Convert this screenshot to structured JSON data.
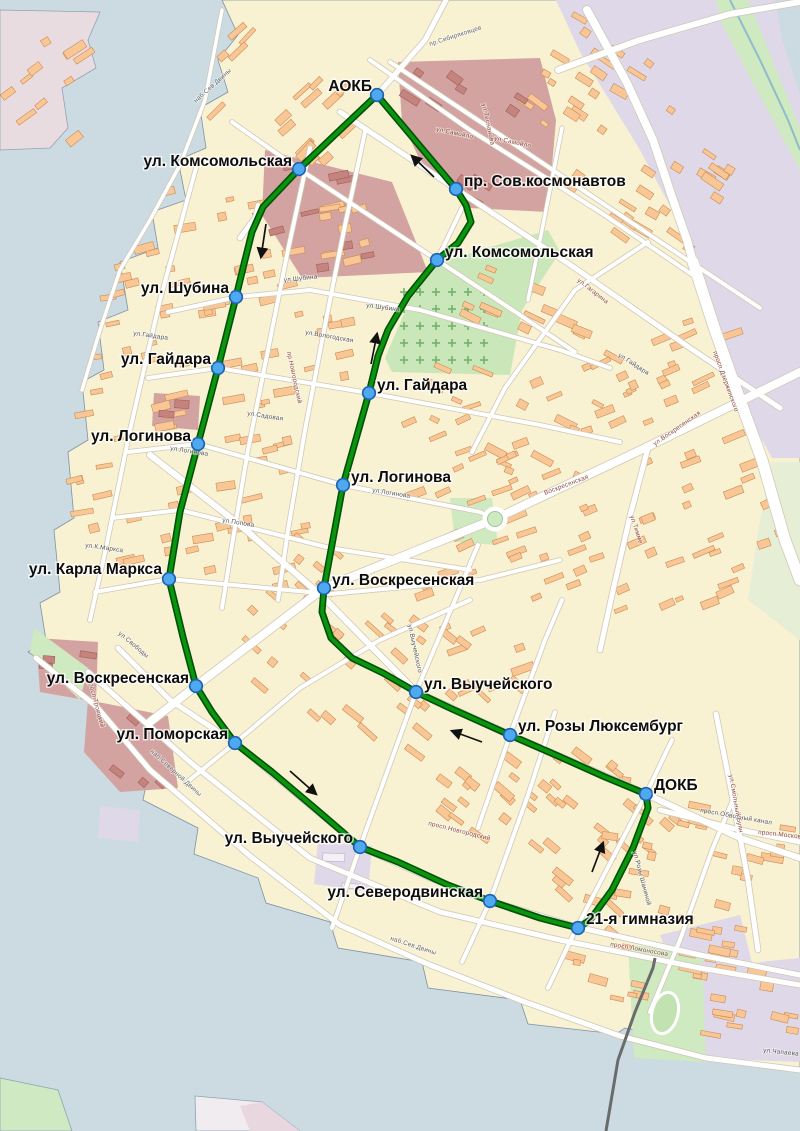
{
  "map": {
    "description": "City bus route map with stops",
    "colors": {
      "water": "#cbdbe1",
      "land": "#f8f1d2",
      "industrial_zone": "#ded8e9",
      "campus_zone": "#d2a3a0",
      "park": "#cfe9c0",
      "cemetery": "#c9e7b8",
      "route_green": "#0c940c",
      "route_casing": "#00510a",
      "stop_fill": "#4ea9f0",
      "stop_border": "#1e63b0",
      "building": "#f8c795",
      "label_color": "#0d0d0d"
    },
    "route_points": [
      [
        377,
        95
      ],
      [
        456,
        189
      ],
      [
        466,
        205
      ],
      [
        471,
        222
      ],
      [
        458,
        243
      ],
      [
        437,
        260
      ],
      [
        408,
        296
      ],
      [
        388,
        330
      ],
      [
        378,
        356
      ],
      [
        369,
        393
      ],
      [
        343,
        485
      ],
      [
        324,
        588
      ],
      [
        322,
        612
      ],
      [
        331,
        638
      ],
      [
        352,
        658
      ],
      [
        383,
        673
      ],
      [
        416,
        692
      ],
      [
        452,
        709
      ],
      [
        510,
        735
      ],
      [
        558,
        756
      ],
      [
        605,
        777
      ],
      [
        646,
        794
      ],
      [
        648,
        808
      ],
      [
        633,
        848
      ],
      [
        612,
        890
      ],
      [
        590,
        920
      ],
      [
        578,
        928
      ],
      [
        540,
        918
      ],
      [
        490,
        901
      ],
      [
        448,
        885
      ],
      [
        398,
        862
      ],
      [
        360,
        847
      ],
      [
        317,
        810
      ],
      [
        272,
        772
      ],
      [
        235,
        743
      ],
      [
        212,
        712
      ],
      [
        196,
        686
      ],
      [
        183,
        637
      ],
      [
        169,
        579
      ],
      [
        180,
        512
      ],
      [
        198,
        444
      ],
      [
        218,
        368
      ],
      [
        236,
        297
      ],
      [
        244,
        264
      ],
      [
        252,
        232
      ],
      [
        263,
        207
      ],
      [
        299,
        169
      ],
      [
        340,
        130
      ]
    ],
    "stops": [
      {
        "name": "АОКБ",
        "x": 377,
        "y": 95,
        "lx": 372,
        "ly": 91,
        "anchor": "end"
      },
      {
        "name": "ул. Комсомольская",
        "x": 299,
        "y": 169,
        "lx": 292,
        "ly": 166,
        "anchor": "end"
      },
      {
        "name": "пр. Сов.космонавтов",
        "x": 456,
        "y": 189,
        "lx": 464,
        "ly": 186,
        "anchor": "start"
      },
      {
        "name": "ул. Комсомольская",
        "x": 437,
        "y": 260,
        "lx": 445,
        "ly": 257,
        "anchor": "start"
      },
      {
        "name": "ул. Шубина",
        "x": 236,
        "y": 297,
        "lx": 229,
        "ly": 293,
        "anchor": "end"
      },
      {
        "name": "ул. Гайдара",
        "x": 218,
        "y": 368,
        "lx": 211,
        "ly": 364,
        "anchor": "end"
      },
      {
        "name": "ул. Гайдара",
        "x": 369,
        "y": 393,
        "lx": 377,
        "ly": 390,
        "anchor": "start"
      },
      {
        "name": "ул. Логинова",
        "x": 198,
        "y": 444,
        "lx": 191,
        "ly": 441,
        "anchor": "end"
      },
      {
        "name": "ул. Логинова",
        "x": 343,
        "y": 485,
        "lx": 351,
        "ly": 482,
        "anchor": "start"
      },
      {
        "name": "ул. Карла Маркса",
        "x": 169,
        "y": 579,
        "lx": 162,
        "ly": 574,
        "anchor": "end"
      },
      {
        "name": "ул. Воскресенская",
        "x": 324,
        "y": 588,
        "lx": 332,
        "ly": 585,
        "anchor": "start"
      },
      {
        "name": "ул. Воскресенская",
        "x": 196,
        "y": 686,
        "lx": 189,
        "ly": 683,
        "anchor": "end"
      },
      {
        "name": "ул. Поморская",
        "x": 235,
        "y": 743,
        "lx": 228,
        "ly": 739,
        "anchor": "end"
      },
      {
        "name": "ул. Выучейского",
        "x": 416,
        "y": 692,
        "lx": 424,
        "ly": 689,
        "anchor": "start"
      },
      {
        "name": "ул. Розы Люксембург",
        "x": 510,
        "y": 735,
        "lx": 518,
        "ly": 731,
        "anchor": "start"
      },
      {
        "name": "ДОКБ",
        "x": 646,
        "y": 794,
        "lx": 654,
        "ly": 790,
        "anchor": "start"
      },
      {
        "name": "ул. Выучейского",
        "x": 360,
        "y": 847,
        "lx": 353,
        "ly": 843,
        "anchor": "end"
      },
      {
        "name": "ул. Северодвинская",
        "x": 490,
        "y": 901,
        "lx": 483,
        "ly": 897,
        "anchor": "end"
      },
      {
        "name": "21-я гимназия",
        "x": 578,
        "y": 928,
        "lx": 586,
        "ly": 924,
        "anchor": "start"
      }
    ],
    "direction_arrows": [
      {
        "x1": 434,
        "y1": 177,
        "x2": 412,
        "y2": 156
      },
      {
        "x1": 266,
        "y1": 224,
        "x2": 261,
        "y2": 257
      },
      {
        "x1": 371,
        "y1": 364,
        "x2": 377,
        "y2": 334
      },
      {
        "x1": 482,
        "y1": 742,
        "x2": 452,
        "y2": 731
      },
      {
        "x1": 290,
        "y1": 771,
        "x2": 316,
        "y2": 794
      },
      {
        "x1": 592,
        "y1": 872,
        "x2": 603,
        "y2": 843
      }
    ],
    "street_labels": [
      {
        "text": "пр.Сибиряковцев",
        "x": 430,
        "y": 46,
        "rot": -18,
        "color": "#666666"
      },
      {
        "text": "ул.Самойло",
        "x": 436,
        "y": 131,
        "rot": 12,
        "color": "#8a4a3c"
      },
      {
        "text": "ул.Самойло",
        "x": 494,
        "y": 140,
        "rot": 12,
        "color": "#8a4a3c"
      },
      {
        "text": "ул.Теснанова",
        "x": 482,
        "y": 104,
        "rot": 78,
        "color": "#8a4a3c"
      },
      {
        "text": "наб.Сев.Двины",
        "x": 196,
        "y": 103,
        "rot": -42,
        "color": "#666666"
      },
      {
        "text": "ул.Гагарина",
        "x": 577,
        "y": 281,
        "rot": 38,
        "color": "#8a4a3c"
      },
      {
        "text": "ул.Шубина",
        "x": 284,
        "y": 282,
        "rot": -6,
        "color": "#555555"
      },
      {
        "text": "ул.Шубина",
        "x": 366,
        "y": 307,
        "rot": 8,
        "color": "#555555"
      },
      {
        "text": "ул.Вологодская",
        "x": 305,
        "y": 334,
        "rot": 10,
        "color": "#555555"
      },
      {
        "text": "пр.Новгородский",
        "x": 287,
        "y": 352,
        "rot": 78,
        "color": "#8a4a3c"
      },
      {
        "text": "ул.Гайдара",
        "x": 133,
        "y": 335,
        "rot": 8,
        "color": "#555555"
      },
      {
        "text": "ул.Гайдара",
        "x": 618,
        "y": 356,
        "rot": 33,
        "color": "#555555"
      },
      {
        "text": "ул.Садовая",
        "x": 247,
        "y": 415,
        "rot": 9,
        "color": "#555555"
      },
      {
        "text": "ул.Логинова",
        "x": 170,
        "y": 450,
        "rot": 9,
        "color": "#555555"
      },
      {
        "text": "ул.Логинова",
        "x": 372,
        "y": 492,
        "rot": 9,
        "color": "#555555"
      },
      {
        "text": "ул.Попова",
        "x": 222,
        "y": 522,
        "rot": 9,
        "color": "#555555"
      },
      {
        "text": "ул.К.Маркса",
        "x": 85,
        "y": 547,
        "rot": 8,
        "color": "#555555"
      },
      {
        "text": "ул.Свободы",
        "x": 118,
        "y": 634,
        "rot": 40,
        "color": "#555555"
      },
      {
        "text": "Воскресенская",
        "x": 545,
        "y": 495,
        "rot": -21,
        "color": "#8a4a3c"
      },
      {
        "text": "ул.Тимме",
        "x": 630,
        "y": 516,
        "rot": 72,
        "color": "#8a4a3c"
      },
      {
        "text": "ул.Выучейского",
        "x": 408,
        "y": 625,
        "rot": 78,
        "color": "#555555"
      },
      {
        "text": "просп.Троицкий",
        "x": 88,
        "y": 680,
        "rot": 75,
        "color": "#8a4a3c"
      },
      {
        "text": "наб.Северной Двины",
        "x": 150,
        "y": 752,
        "rot": 42,
        "color": "#666666"
      },
      {
        "text": "просп.Новгородский",
        "x": 428,
        "y": 825,
        "rot": 14,
        "color": "#8a4a3c"
      },
      {
        "text": "просп.Обводный канал",
        "x": 700,
        "y": 812,
        "rot": 10,
        "color": "#555555"
      },
      {
        "text": "ул.Розы Шаниной",
        "x": 633,
        "y": 852,
        "rot": 75,
        "color": "#555555"
      },
      {
        "text": "просп.Московский",
        "x": 758,
        "y": 834,
        "rot": 6,
        "color": "#8a4a3c"
      },
      {
        "text": "ул.Смольный Буян",
        "x": 729,
        "y": 775,
        "rot": 80,
        "color": "#8a4a3c"
      },
      {
        "text": "просп.Ломоносова",
        "x": 610,
        "y": 946,
        "rot": 10,
        "color": "#8a4a3c"
      },
      {
        "text": "наб.Сев.Двины",
        "x": 390,
        "y": 940,
        "rot": 18,
        "color": "#666666"
      },
      {
        "text": "просп.Дзержинского",
        "x": 713,
        "y": 352,
        "rot": 70,
        "color": "#8a4a3c"
      },
      {
        "text": "ул.Воскресенская",
        "x": 655,
        "y": 446,
        "rot": -35,
        "color": "#8a4a3c"
      },
      {
        "text": "ул.Чапаева",
        "x": 763,
        "y": 1052,
        "rot": 6,
        "color": "#555555"
      }
    ]
  }
}
